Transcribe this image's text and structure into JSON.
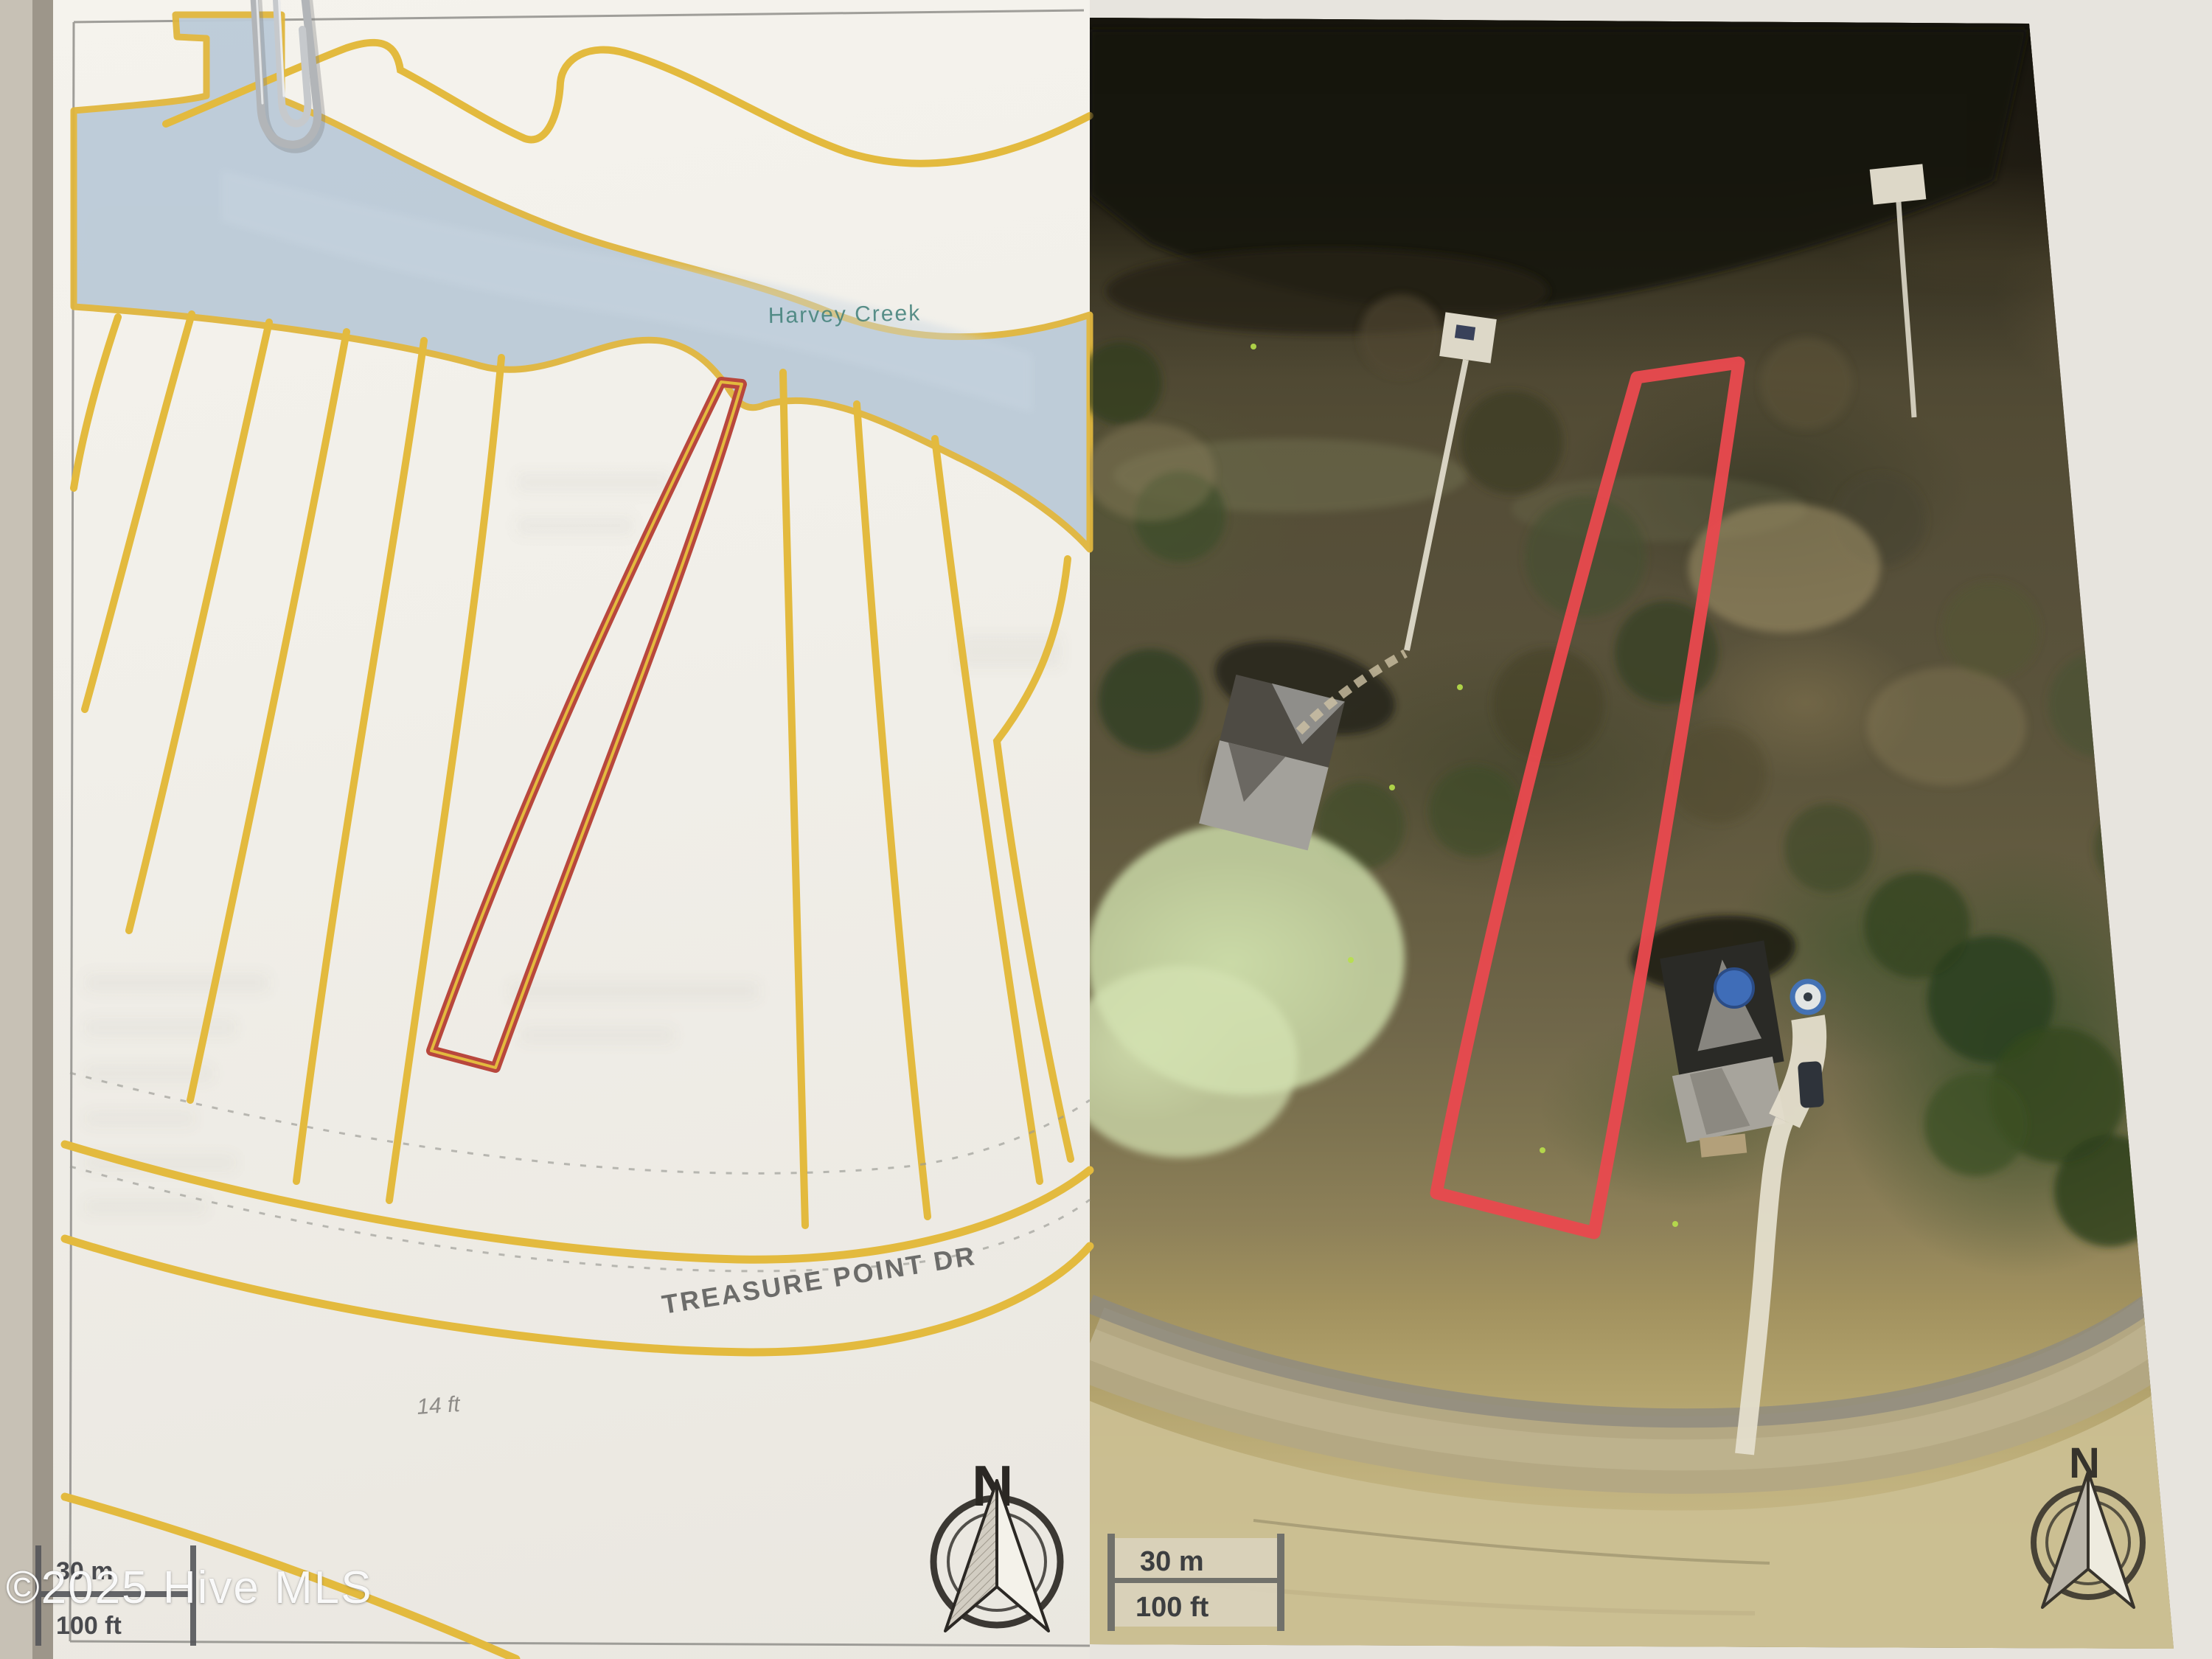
{
  "page": {
    "watermark": "©2025 Hive MLS",
    "description": "Photographed printed sheet with paperclip: plat map (left) and aerial parcel photo (right)"
  },
  "plat_map": {
    "creek_label": "Harvey Creek",
    "street_label": "TREASURE POINT DR",
    "dimension_label": "14 ft",
    "compass_label": "N",
    "scale": {
      "metric": "30 m",
      "imperial": "100 ft"
    },
    "colors": {
      "lot_line_yellow": "#e3ba3e",
      "highlight_lot_red": "#b8473d",
      "water_blue": "#bccbd8",
      "creek_label_teal": "#3f7f78"
    }
  },
  "aerial_map": {
    "compass_label": "N",
    "scale": {
      "metric": "30 m",
      "imperial": "100 ft"
    },
    "colors": {
      "parcel_outline_red": "#e8494e"
    }
  }
}
